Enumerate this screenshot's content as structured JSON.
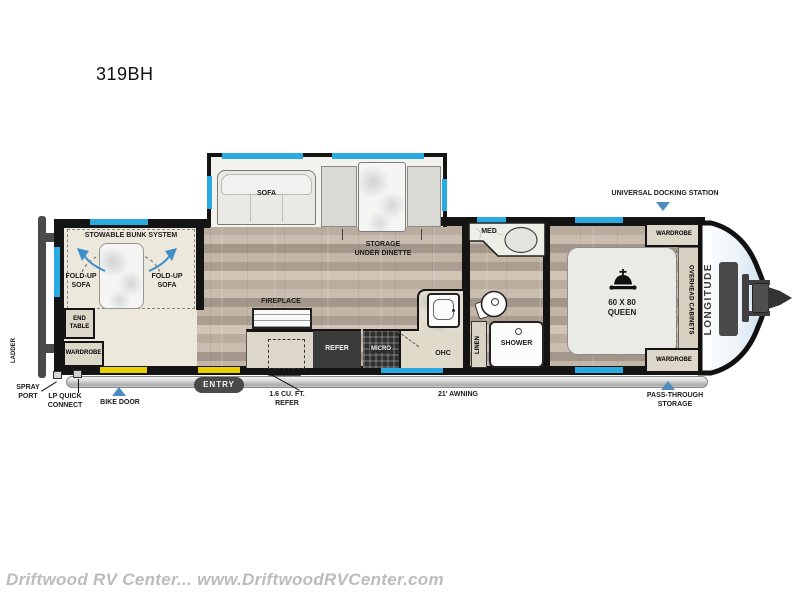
{
  "title": "319BH",
  "watermark": "Driftwood RV Center... www.DriftwoodRVCenter.com",
  "brand": "LONGITUDE",
  "colors": {
    "window_accent": "#29aae1",
    "door_accent": "#e9d000",
    "marker_arrow": "#4e8bc0",
    "wall": "#141414"
  },
  "bunk_room": {
    "title": "STOWABLE BUNK SYSTEM",
    "fold_up_sofa_left": "FOLD-UP\nSOFA",
    "fold_up_sofa_right": "FOLD-UP\nSOFA",
    "end_table": "END\nTABLE",
    "wardrobe": "WARDROBE"
  },
  "living_area": {
    "sofa": "SOFA",
    "storage_under_dinette": "STORAGE\nUNDER DINETTE",
    "fireplace": "FIREPLACE"
  },
  "kitchen": {
    "refer": "REFER",
    "micro": "MICRO",
    "ohc": "OHC"
  },
  "bathroom": {
    "med": "MED",
    "linen": "LINEN",
    "shower": "SHOWER"
  },
  "bedroom": {
    "bed": "60 X 80\nQUEEN",
    "wardrobe_top": "WARDROBE",
    "wardrobe_bottom": "WARDROBE",
    "overhead_cabinets": "OVERHEAD CABINETS"
  },
  "exterior": {
    "ladder": "LADDER",
    "spray_port": "SPRAY\nPORT",
    "lp_quick_connect": "LP QUICK\nCONNECT",
    "bike_door": "BIKE DOOR",
    "entry": "ENTRY",
    "exterior_refer": "1.6 CU. FT.\nREFER",
    "awning": "21' AWNING",
    "universal_docking_station": "UNIVERSAL DOCKING STATION",
    "pass_through_storage": "PASS-THROUGH\nSTORAGE"
  }
}
